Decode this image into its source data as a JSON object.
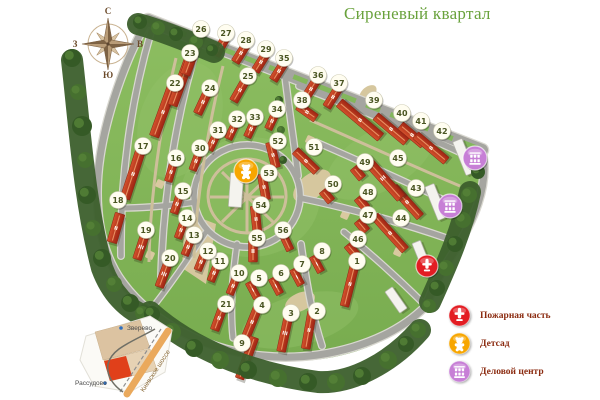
{
  "title": {
    "text": "Сиреневый квартал",
    "color": "#69a23c"
  },
  "compass": {
    "n": "С",
    "e": "В",
    "s": "Ю",
    "w": "З",
    "cx": 108,
    "cy": 44
  },
  "legend": {
    "text_color": "#8b2b10",
    "items": [
      {
        "id": "fire",
        "label": "Пожарная часть",
        "color": "#e31d23",
        "icon": "fire-station-icon"
      },
      {
        "id": "kindergarten",
        "label": "Детсад",
        "color": "#f7a600",
        "icon": "kindergarten-icon"
      },
      {
        "id": "business",
        "label": "Деловой центр",
        "color": "#c77fd6",
        "icon": "business-center-icon"
      }
    ]
  },
  "inset": {
    "towns": [
      {
        "name": "Зверево",
        "tx": 127,
        "ty": 330,
        "dx": 121,
        "dy": 328
      },
      {
        "name": "Рассудово",
        "tx": 75,
        "ty": 385,
        "dx": 105,
        "dy": 383
      }
    ],
    "highway_label": "Киевское шоссе"
  },
  "map": {
    "colors": {
      "grass": "#84b65a",
      "grass_light": "#93c268",
      "forest": "#3c5f2c",
      "road": "#a5a5a0",
      "road_edge": "#d9d8d0",
      "path": "#cdbf9a",
      "building_light": "#d4512c",
      "building_dark": "#9e2413",
      "marker_fill": "#fffdf0",
      "marker_text": "#4a5522"
    },
    "facilities": [
      {
        "type": "kindergarten",
        "x": 246,
        "y": 171,
        "r": 12,
        "color": "#f7a600"
      },
      {
        "type": "business",
        "x": 475,
        "y": 158,
        "r": 12,
        "color": "#c77fd6"
      },
      {
        "type": "business",
        "x": 450,
        "y": 206,
        "r": 12,
        "color": "#c77fd6"
      },
      {
        "type": "fire",
        "x": 427,
        "y": 266,
        "r": 11,
        "color": "#e31d23"
      }
    ],
    "markers": [
      {
        "n": "1",
        "x": 357,
        "y": 261,
        "bx": 350,
        "by": 284,
        "a": 14,
        "l": 46,
        "w": 9,
        "f": "II"
      },
      {
        "n": "2",
        "x": 317,
        "y": 311,
        "bx": 309,
        "by": 330,
        "a": 10,
        "l": 38,
        "w": 9,
        "f": "II"
      },
      {
        "n": "3",
        "x": 291,
        "y": 313,
        "bx": 285,
        "by": 333,
        "a": 12,
        "l": 38,
        "w": 9,
        "f": "III"
      },
      {
        "n": "4",
        "x": 262,
        "y": 305,
        "bx": 252,
        "by": 322,
        "a": 22,
        "l": 44,
        "w": 9,
        "f": "II"
      },
      {
        "n": "5",
        "x": 259,
        "y": 278,
        "bx": 253,
        "by": 290,
        "a": -28,
        "l": 18,
        "w": 8,
        "f": "I"
      },
      {
        "n": "6",
        "x": 281,
        "y": 273,
        "bx": 276,
        "by": 286,
        "a": -28,
        "l": 18,
        "w": 8,
        "f": "I"
      },
      {
        "n": "7",
        "x": 302,
        "y": 264,
        "bx": 297,
        "by": 277,
        "a": -28,
        "l": 18,
        "w": 8,
        "f": "I"
      },
      {
        "n": "8",
        "x": 322,
        "y": 251,
        "bx": 317,
        "by": 264,
        "a": -28,
        "l": 18,
        "w": 8,
        "f": "I"
      },
      {
        "n": "9",
        "x": 242,
        "y": 343,
        "bx": 247,
        "by": 358,
        "a": 20,
        "l": 44,
        "w": 9,
        "f": "II"
      },
      {
        "n": "10",
        "x": 239,
        "y": 273,
        "bx": 233,
        "by": 286,
        "a": 22,
        "l": 18,
        "w": 8,
        "f": "II"
      },
      {
        "n": "11",
        "x": 220,
        "y": 261,
        "bx": 214,
        "by": 273,
        "a": 22,
        "l": 18,
        "w": 8,
        "f": "II"
      },
      {
        "n": "12",
        "x": 208,
        "y": 251,
        "bx": 201,
        "by": 262,
        "a": 22,
        "l": 18,
        "w": 8,
        "f": "II"
      },
      {
        "n": "13",
        "x": 194,
        "y": 235,
        "bx": 188,
        "by": 247,
        "a": 22,
        "l": 18,
        "w": 8,
        "f": "II"
      },
      {
        "n": "14",
        "x": 187,
        "y": 218,
        "bx": 181,
        "by": 230,
        "a": 20,
        "l": 18,
        "w": 8,
        "f": "II"
      },
      {
        "n": "15",
        "x": 183,
        "y": 191,
        "bx": 177,
        "by": 204,
        "a": 18,
        "l": 20,
        "w": 8,
        "f": "II"
      },
      {
        "n": "16",
        "x": 176,
        "y": 158,
        "bx": 171,
        "by": 172,
        "a": 16,
        "l": 20,
        "w": 8,
        "f": "II"
      },
      {
        "n": "17",
        "x": 143,
        "y": 146,
        "bx": 133,
        "by": 174,
        "a": 18,
        "l": 52,
        "w": 10,
        "f": "II"
      },
      {
        "n": "18",
        "x": 118,
        "y": 200,
        "bx": 116,
        "by": 228,
        "a": 16,
        "l": 30,
        "w": 10,
        "f": "II"
      },
      {
        "n": "19",
        "x": 146,
        "y": 230,
        "bx": 141,
        "by": 247,
        "a": 18,
        "l": 26,
        "w": 9,
        "f": "III"
      },
      {
        "n": "20",
        "x": 170,
        "y": 258,
        "bx": 164,
        "by": 274,
        "a": 20,
        "l": 28,
        "w": 9,
        "f": "III"
      },
      {
        "n": "21",
        "x": 226,
        "y": 304,
        "bx": 219,
        "by": 318,
        "a": 20,
        "l": 26,
        "w": 9,
        "f": "II"
      },
      {
        "n": "22",
        "x": 175,
        "y": 83,
        "bx": 163,
        "by": 112,
        "a": 20,
        "l": 52,
        "w": 10,
        "f": "II"
      },
      {
        "n": "23",
        "x": 190,
        "y": 53,
        "bx": 181,
        "by": 82,
        "a": 20,
        "l": 50,
        "w": 10,
        "f": "II"
      },
      {
        "n": "24",
        "x": 210,
        "y": 88,
        "bx": 203,
        "by": 102,
        "a": 25,
        "l": 26,
        "w": 9,
        "f": "II"
      },
      {
        "n": "25",
        "x": 248,
        "y": 76,
        "bx": 240,
        "by": 90,
        "a": 30,
        "l": 26,
        "w": 9,
        "f": "II"
      },
      {
        "n": "26",
        "x": 201,
        "y": 29,
        "bx": 193,
        "by": 53,
        "a": 20,
        "l": 46,
        "w": 10,
        "f": "II"
      },
      {
        "n": "27",
        "x": 226,
        "y": 33,
        "bx": 221,
        "by": 46,
        "a": 30,
        "l": 22,
        "w": 9,
        "f": "II"
      },
      {
        "n": "28",
        "x": 246,
        "y": 40,
        "bx": 241,
        "by": 53,
        "a": 32,
        "l": 22,
        "w": 9,
        "f": "II"
      },
      {
        "n": "29",
        "x": 266,
        "y": 49,
        "bx": 261,
        "by": 62,
        "a": 32,
        "l": 22,
        "w": 9,
        "f": "II"
      },
      {
        "n": "30",
        "x": 200,
        "y": 148,
        "bx": 196,
        "by": 161,
        "a": 20,
        "l": 20,
        "w": 8,
        "f": "II"
      },
      {
        "n": "31",
        "x": 218,
        "y": 130,
        "bx": 213,
        "by": 142,
        "a": 25,
        "l": 18,
        "w": 8,
        "f": "II"
      },
      {
        "n": "32",
        "x": 237,
        "y": 119,
        "bx": 232,
        "by": 131,
        "a": 25,
        "l": 18,
        "w": 8,
        "f": "II"
      },
      {
        "n": "33",
        "x": 255,
        "y": 117,
        "bx": 251,
        "by": 129,
        "a": 25,
        "l": 18,
        "w": 8,
        "f": "II"
      },
      {
        "n": "34",
        "x": 277,
        "y": 109,
        "bx": 272,
        "by": 121,
        "a": 25,
        "l": 18,
        "w": 8,
        "f": "II"
      },
      {
        "n": "35",
        "x": 284,
        "y": 58,
        "bx": 279,
        "by": 71,
        "a": 32,
        "l": 22,
        "w": 9,
        "f": "II"
      },
      {
        "n": "36",
        "x": 318,
        "y": 75,
        "bx": 311,
        "by": 89,
        "a": 32,
        "l": 24,
        "w": 9,
        "f": "II"
      },
      {
        "n": "37",
        "x": 339,
        "y": 83,
        "bx": 333,
        "by": 97,
        "a": 32,
        "l": 24,
        "w": 9,
        "f": "II"
      },
      {
        "n": "38",
        "x": 302,
        "y": 100,
        "bx": 307,
        "by": 112,
        "a": -55,
        "l": 22,
        "w": 9,
        "f": "II"
      },
      {
        "n": "39",
        "x": 374,
        "y": 100,
        "bx": 360,
        "by": 120,
        "a": -50,
        "l": 54,
        "w": 10,
        "f": "II"
      },
      {
        "n": "40",
        "x": 402,
        "y": 113,
        "bx": 391,
        "by": 129,
        "a": -50,
        "l": 40,
        "w": 9,
        "f": "II"
      },
      {
        "n": "41",
        "x": 421,
        "y": 121,
        "bx": 412,
        "by": 135,
        "a": -50,
        "l": 30,
        "w": 9,
        "f": "II"
      },
      {
        "n": "42",
        "x": 442,
        "y": 131,
        "bx": 431,
        "by": 148,
        "a": -50,
        "l": 40,
        "w": 9,
        "f": "II"
      },
      {
        "n": "43",
        "x": 416,
        "y": 188,
        "bx": 407,
        "by": 202,
        "a": -42,
        "l": 40,
        "w": 9,
        "f": "II"
      },
      {
        "n": "44",
        "x": 401,
        "y": 218,
        "bx": 390,
        "by": 233,
        "a": -42,
        "l": 46,
        "w": 9,
        "f": "II"
      },
      {
        "n": "45",
        "x": 398,
        "y": 158,
        "bx": 383,
        "by": 178,
        "a": -42,
        "l": 54,
        "w": 10,
        "f": "III"
      },
      {
        "n": "46",
        "x": 358,
        "y": 239,
        "bx": 352,
        "by": 250,
        "a": -40,
        "l": 14,
        "w": 9,
        "f": "I"
      },
      {
        "n": "47",
        "x": 368,
        "y": 215,
        "bx": 362,
        "by": 226,
        "a": -40,
        "l": 14,
        "w": 9,
        "f": "I"
      },
      {
        "n": "48",
        "x": 368,
        "y": 192,
        "bx": 362,
        "by": 203,
        "a": -40,
        "l": 14,
        "w": 9,
        "f": "I"
      },
      {
        "n": "49",
        "x": 365,
        "y": 162,
        "bx": 358,
        "by": 173,
        "a": -40,
        "l": 14,
        "w": 9,
        "f": "I"
      },
      {
        "n": "50",
        "x": 333,
        "y": 184,
        "bx": 327,
        "by": 196,
        "a": -40,
        "l": 14,
        "w": 9,
        "f": "I"
      },
      {
        "n": "51",
        "x": 314,
        "y": 147,
        "bx": 306,
        "by": 161,
        "a": -46,
        "l": 30,
        "w": 9,
        "f": "II"
      },
      {
        "n": "52",
        "x": 278,
        "y": 141,
        "bx": 273,
        "by": 155,
        "a": -14,
        "l": 26,
        "w": 9,
        "f": "II"
      },
      {
        "n": "53",
        "x": 269,
        "y": 173,
        "bx": 264,
        "by": 187,
        "a": -10,
        "l": 26,
        "w": 9,
        "f": "II"
      },
      {
        "n": "54",
        "x": 261,
        "y": 205,
        "bx": 256,
        "by": 219,
        "a": -6,
        "l": 26,
        "w": 9,
        "f": "II"
      },
      {
        "n": "55",
        "x": 257,
        "y": 238,
        "bx": 253,
        "by": 251,
        "a": 0,
        "l": 22,
        "w": 9,
        "f": "II"
      },
      {
        "n": "56",
        "x": 283,
        "y": 230,
        "bx": 287,
        "by": 243,
        "a": -25,
        "l": 16,
        "w": 8,
        "f": "I"
      }
    ],
    "white_buildings": [
      {
        "x": 464,
        "y": 157,
        "a": -22,
        "l": 36,
        "w": 10
      },
      {
        "x": 436,
        "y": 202,
        "a": -22,
        "l": 36,
        "w": 10
      },
      {
        "x": 421,
        "y": 254,
        "a": -22,
        "l": 26,
        "w": 9
      },
      {
        "x": 396,
        "y": 300,
        "a": -35,
        "l": 26,
        "w": 9
      },
      {
        "x": 236,
        "y": 190,
        "a": 4,
        "l": 34,
        "w": 13
      }
    ],
    "trees": [
      [
        72,
        58,
        9
      ],
      [
        78,
        92,
        8
      ],
      [
        82,
        126,
        10
      ],
      [
        85,
        160,
        8
      ],
      [
        87,
        195,
        9
      ],
      [
        93,
        228,
        8
      ],
      [
        102,
        258,
        9
      ],
      [
        114,
        284,
        8
      ],
      [
        130,
        303,
        9
      ],
      [
        142,
        313,
        7
      ],
      [
        140,
        22,
        7
      ],
      [
        158,
        28,
        7
      ],
      [
        176,
        34,
        7
      ],
      [
        196,
        42,
        7
      ],
      [
        212,
        50,
        6
      ],
      [
        469,
        195,
        8
      ],
      [
        478,
        172,
        7
      ],
      [
        463,
        220,
        8
      ],
      [
        455,
        244,
        8
      ],
      [
        446,
        268,
        8
      ],
      [
        437,
        288,
        8
      ],
      [
        429,
        306,
        7
      ],
      [
        152,
        314,
        8
      ],
      [
        172,
        332,
        9
      ],
      [
        194,
        348,
        9
      ],
      [
        220,
        360,
        9
      ],
      [
        248,
        370,
        9
      ],
      [
        278,
        378,
        9
      ],
      [
        308,
        382,
        9
      ],
      [
        336,
        382,
        9
      ],
      [
        362,
        376,
        9
      ],
      [
        388,
        360,
        9
      ],
      [
        406,
        344,
        8
      ],
      [
        418,
        330,
        8
      ],
      [
        279,
        100,
        4
      ],
      [
        281,
        130,
        4
      ],
      [
        283,
        160,
        4
      ]
    ]
  }
}
